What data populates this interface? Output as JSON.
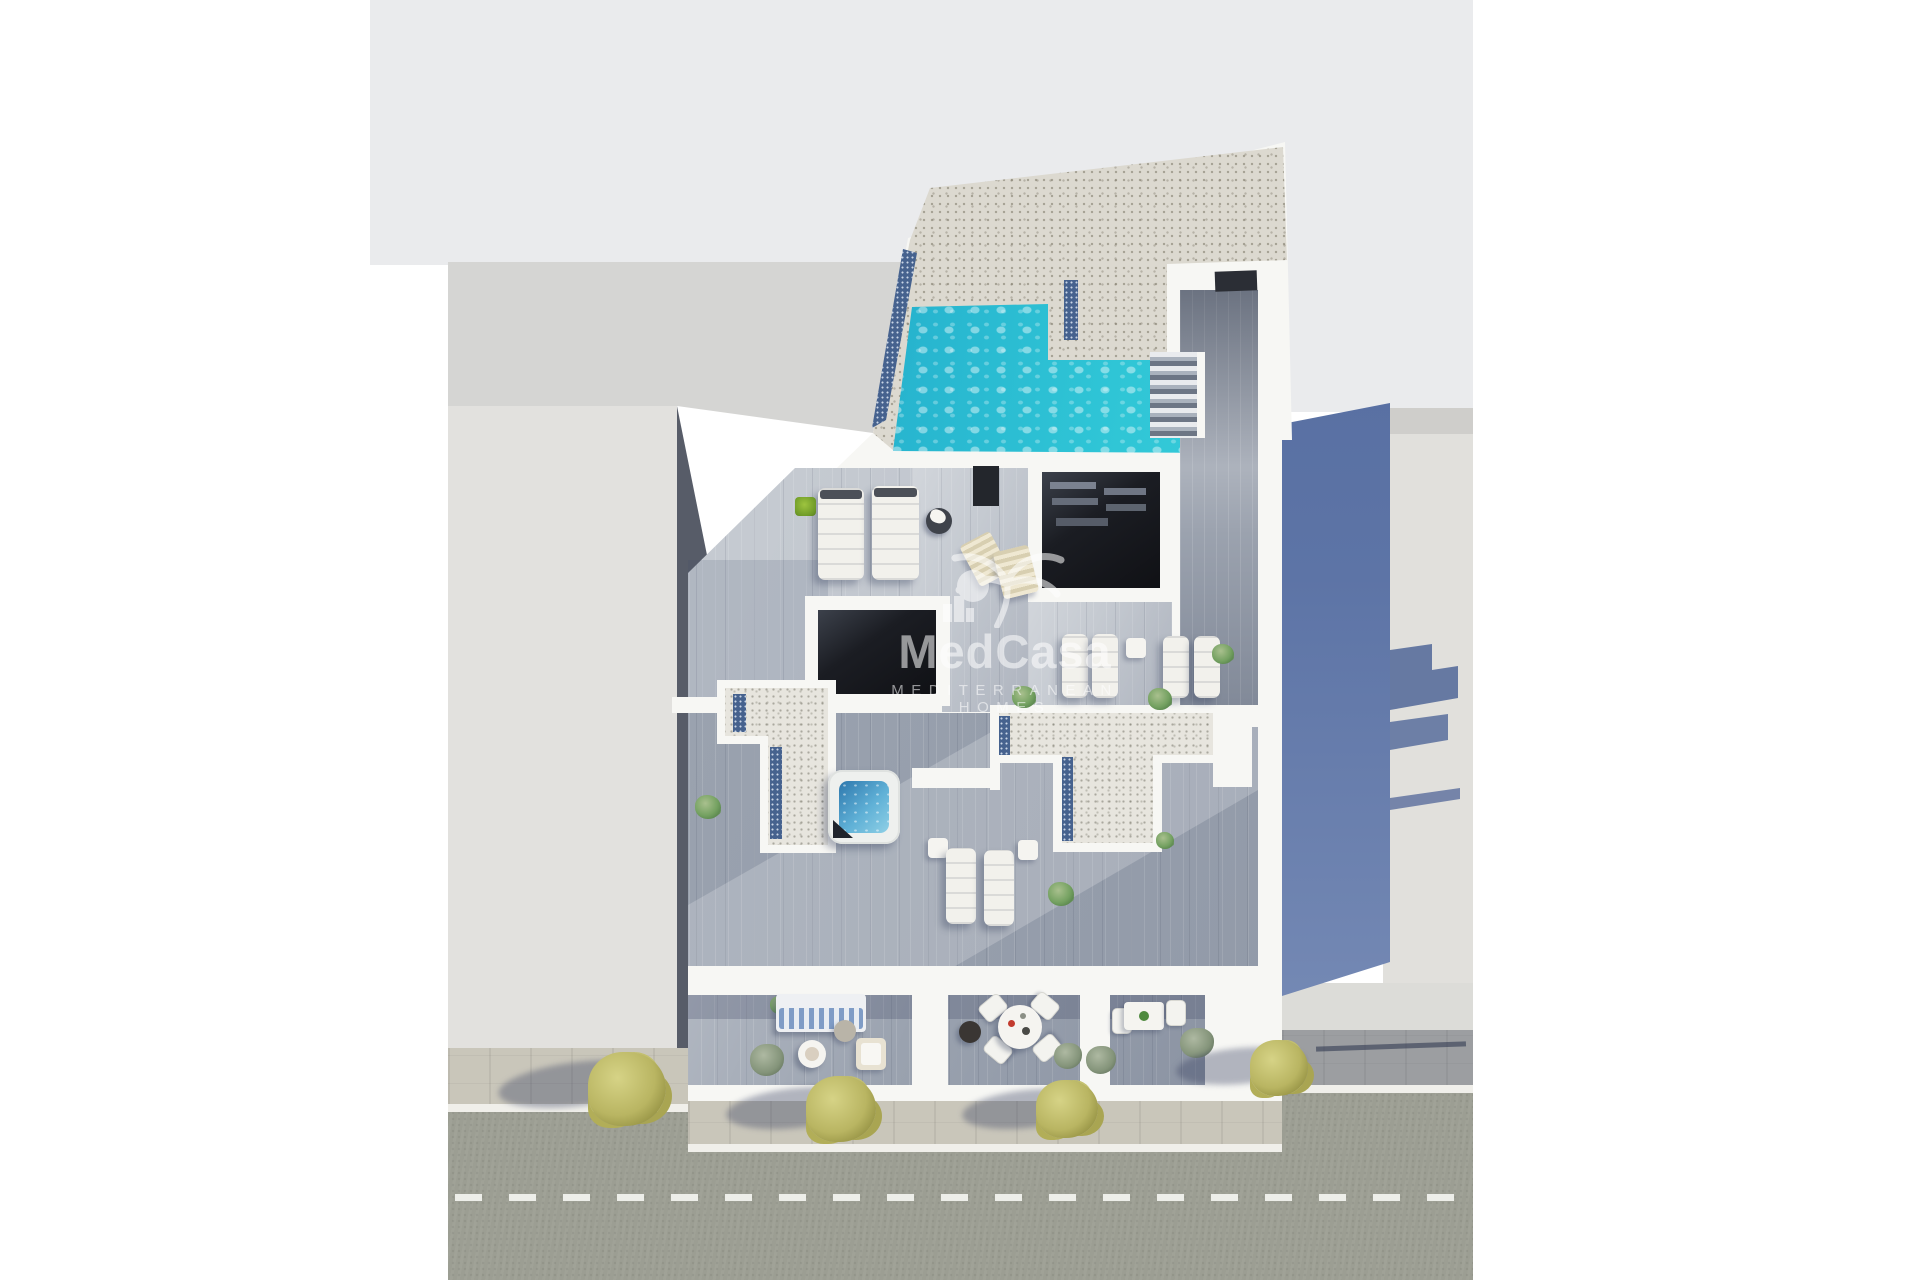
{
  "watermark": {
    "brand": "MedCasa",
    "tagline": "MEDITERRANEAN HOMES",
    "icon": "palm-tree-city-icon"
  },
  "colors": {
    "building_white": "#f7f7f4",
    "backdrop": "#eaebed",
    "neighbor_roof": "#e2e1de",
    "neighbor_face": "#d5d5d3",
    "deck": "#9aa2af",
    "deck_light": "#c5cad1",
    "deck_dark": "#8d95a3",
    "gravel": "#dcd9d0",
    "gravel_light": "#e7e5de",
    "pool_turquoise": "#2fc5d6",
    "pool_deep": "#0e5e96",
    "skylight": "#46628e",
    "shadow_blue": "#53699c",
    "road": "#9c9e93",
    "sidewalk": "#c9c6ba",
    "road_marking": "#edeee9",
    "foliage": "#b9b562",
    "plant_green": "#6f9c5f",
    "void_dark": "#17191e"
  }
}
